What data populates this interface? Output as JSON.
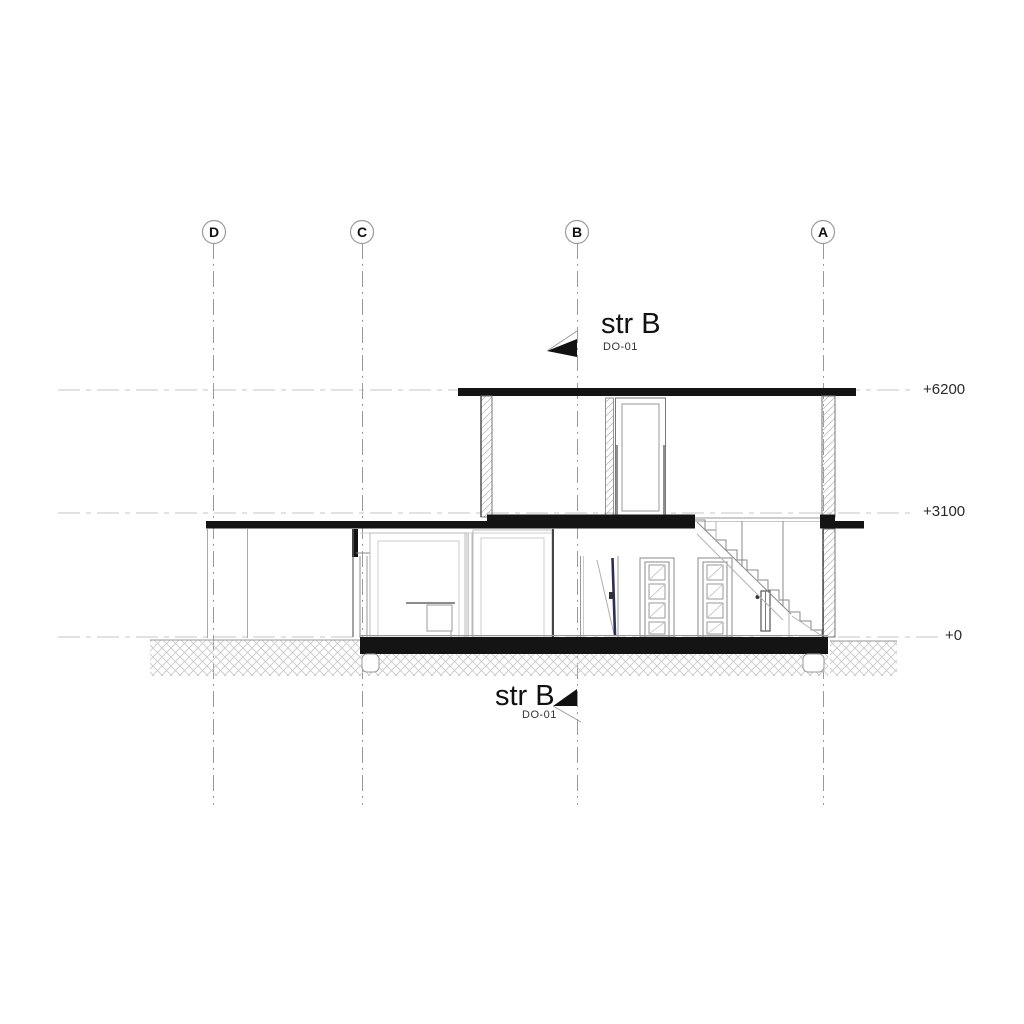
{
  "drawing": {
    "type_label": "building section elevation",
    "grid_columns": [
      {
        "label": "D"
      },
      {
        "label": "C"
      },
      {
        "label": "B"
      },
      {
        "label": "A"
      }
    ],
    "levels": [
      {
        "label": "+6200"
      },
      {
        "label": "+3100"
      },
      {
        "label": "+0"
      }
    ],
    "markers": {
      "top": {
        "title": "str B",
        "ref": "DO-01"
      },
      "bottom": {
        "title": "str B",
        "ref": "DO-01"
      }
    },
    "colors": {
      "cut_black": "#141414",
      "line_gray": "#777777",
      "light_gray": "#c7c7c7",
      "door_leaf_accent": "#2e2e55"
    }
  }
}
